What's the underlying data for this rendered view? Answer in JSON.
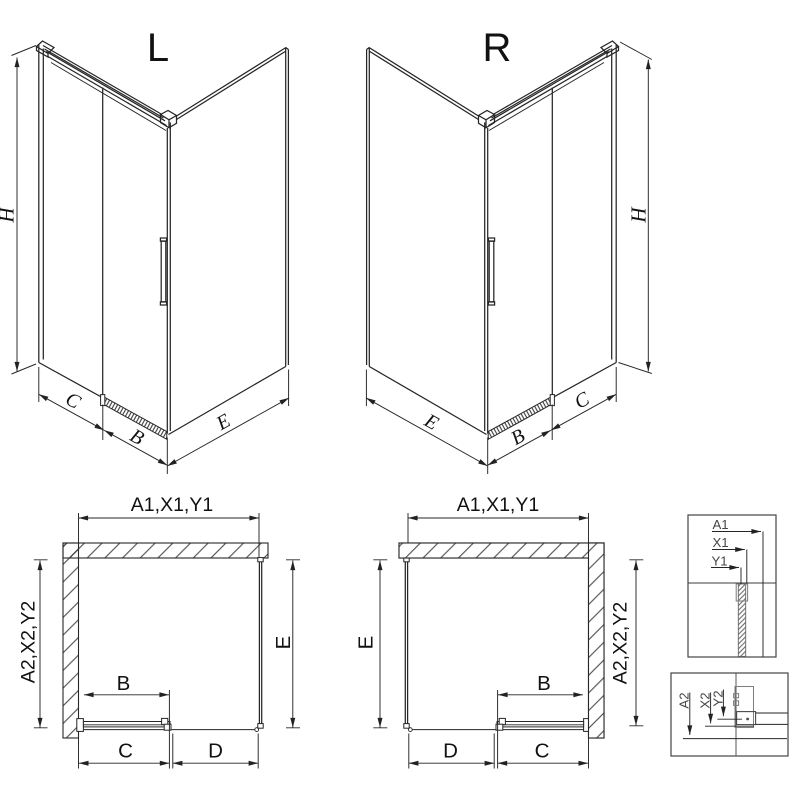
{
  "drawing": {
    "background": "#ffffff",
    "line_color": "#262626",
    "views": {
      "iso_left": {
        "title": "L",
        "dim_height": "H",
        "dim_fixed": "C",
        "dim_door": "B",
        "dim_side": "E"
      },
      "iso_right": {
        "title": "R",
        "dim_height": "H",
        "dim_fixed": "C",
        "dim_door": "B",
        "dim_side": "E"
      },
      "plan_left": {
        "dim_top": "A1,X1,Y1",
        "dim_left": "A2,X2,Y2",
        "dim_right": "E",
        "dim_door": "B",
        "dim_bottom_1": "C",
        "dim_bottom_2": "D"
      },
      "plan_right": {
        "dim_top": "A1,X1,Y1",
        "dim_right": "A2,X2,Y2",
        "dim_left": "E",
        "dim_door": "B",
        "dim_bottom_1": "D",
        "dim_bottom_2": "C"
      },
      "detail_wall": {
        "dim_1": "A1",
        "dim_2": "X1",
        "dim_3": "Y1"
      },
      "detail_floor": {
        "dim_1": "A2",
        "dim_2": "X2",
        "dim_3": "Y2"
      }
    }
  }
}
